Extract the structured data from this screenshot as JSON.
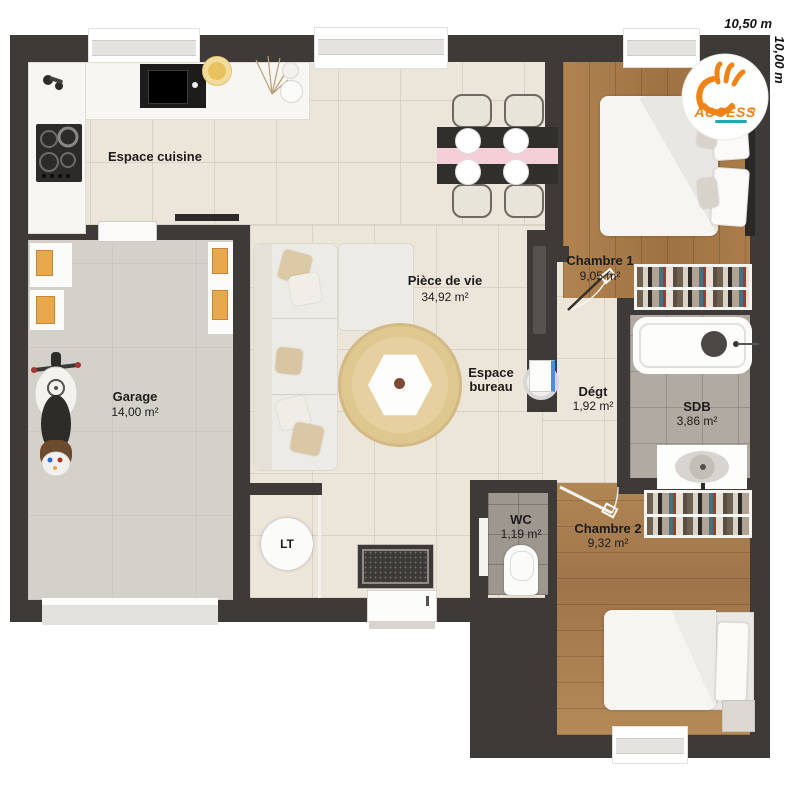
{
  "dimensions": {
    "width_label": "10,50 m",
    "height_label": "10,00 m"
  },
  "logo": {
    "brand": "ACCESS"
  },
  "rooms": {
    "cuisine": {
      "name": "Espace cuisine"
    },
    "piece_de_vie": {
      "name": "Pièce de vie",
      "area": "34,92 m²"
    },
    "bureau": {
      "name": "Espace bureau"
    },
    "garage": {
      "name": "Garage",
      "area": "14,00 m²"
    },
    "chambre1": {
      "name": "Chambre 1",
      "area": "9,05 m²"
    },
    "degt": {
      "name": "Dégt",
      "area": "1,92 m²"
    },
    "sdb": {
      "name": "SDB",
      "area": "3,86 m²"
    },
    "wc": {
      "name": "WC",
      "area": "1,19 m²"
    },
    "chambre2": {
      "name": "Chambre 2",
      "area": "9,32 m²"
    },
    "lt": {
      "name": "LT"
    }
  },
  "colors": {
    "wall": "#3e3a37",
    "tile_floor": "#ece5da",
    "wood_floor": "#a87c4e",
    "garage_floor": "#d4d1ca",
    "logo_orange": "#ef8318",
    "logo_teal": "#2aa3ae",
    "runner_pink": "#f4cfd8"
  }
}
